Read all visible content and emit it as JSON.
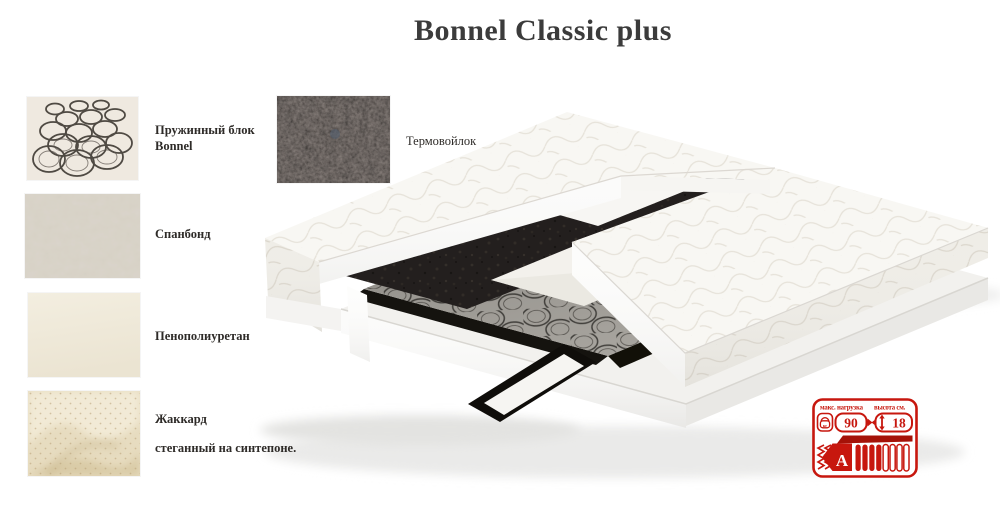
{
  "title": "Bonnel Classic plus",
  "materials": [
    {
      "id": "springs",
      "line1": "Пружинный блок",
      "line2": "Bonnel"
    },
    {
      "id": "spunbond",
      "line1": "Спанбонд",
      "line2": ""
    },
    {
      "id": "foam",
      "line1": "Пенополиуретан",
      "line2": ""
    },
    {
      "id": "jacquard",
      "line1": "Жаккард",
      "line2": "стеганный на синтепоне."
    },
    {
      "id": "feltpad",
      "line1": "Термовойлок",
      "line2": ""
    }
  ],
  "badge": {
    "max_load_label": "макс. нагрузка",
    "max_load_value": "90",
    "max_load_unit": "кг",
    "height_label": "высота см.",
    "height_value": "18",
    "grade_letter": "A",
    "accent_color": "#c7170e",
    "bar_color": "#a51208"
  },
  "colors": {
    "title": "#3b3b3b",
    "felt_dark": "#262220",
    "spring_steel": "#44423e"
  }
}
